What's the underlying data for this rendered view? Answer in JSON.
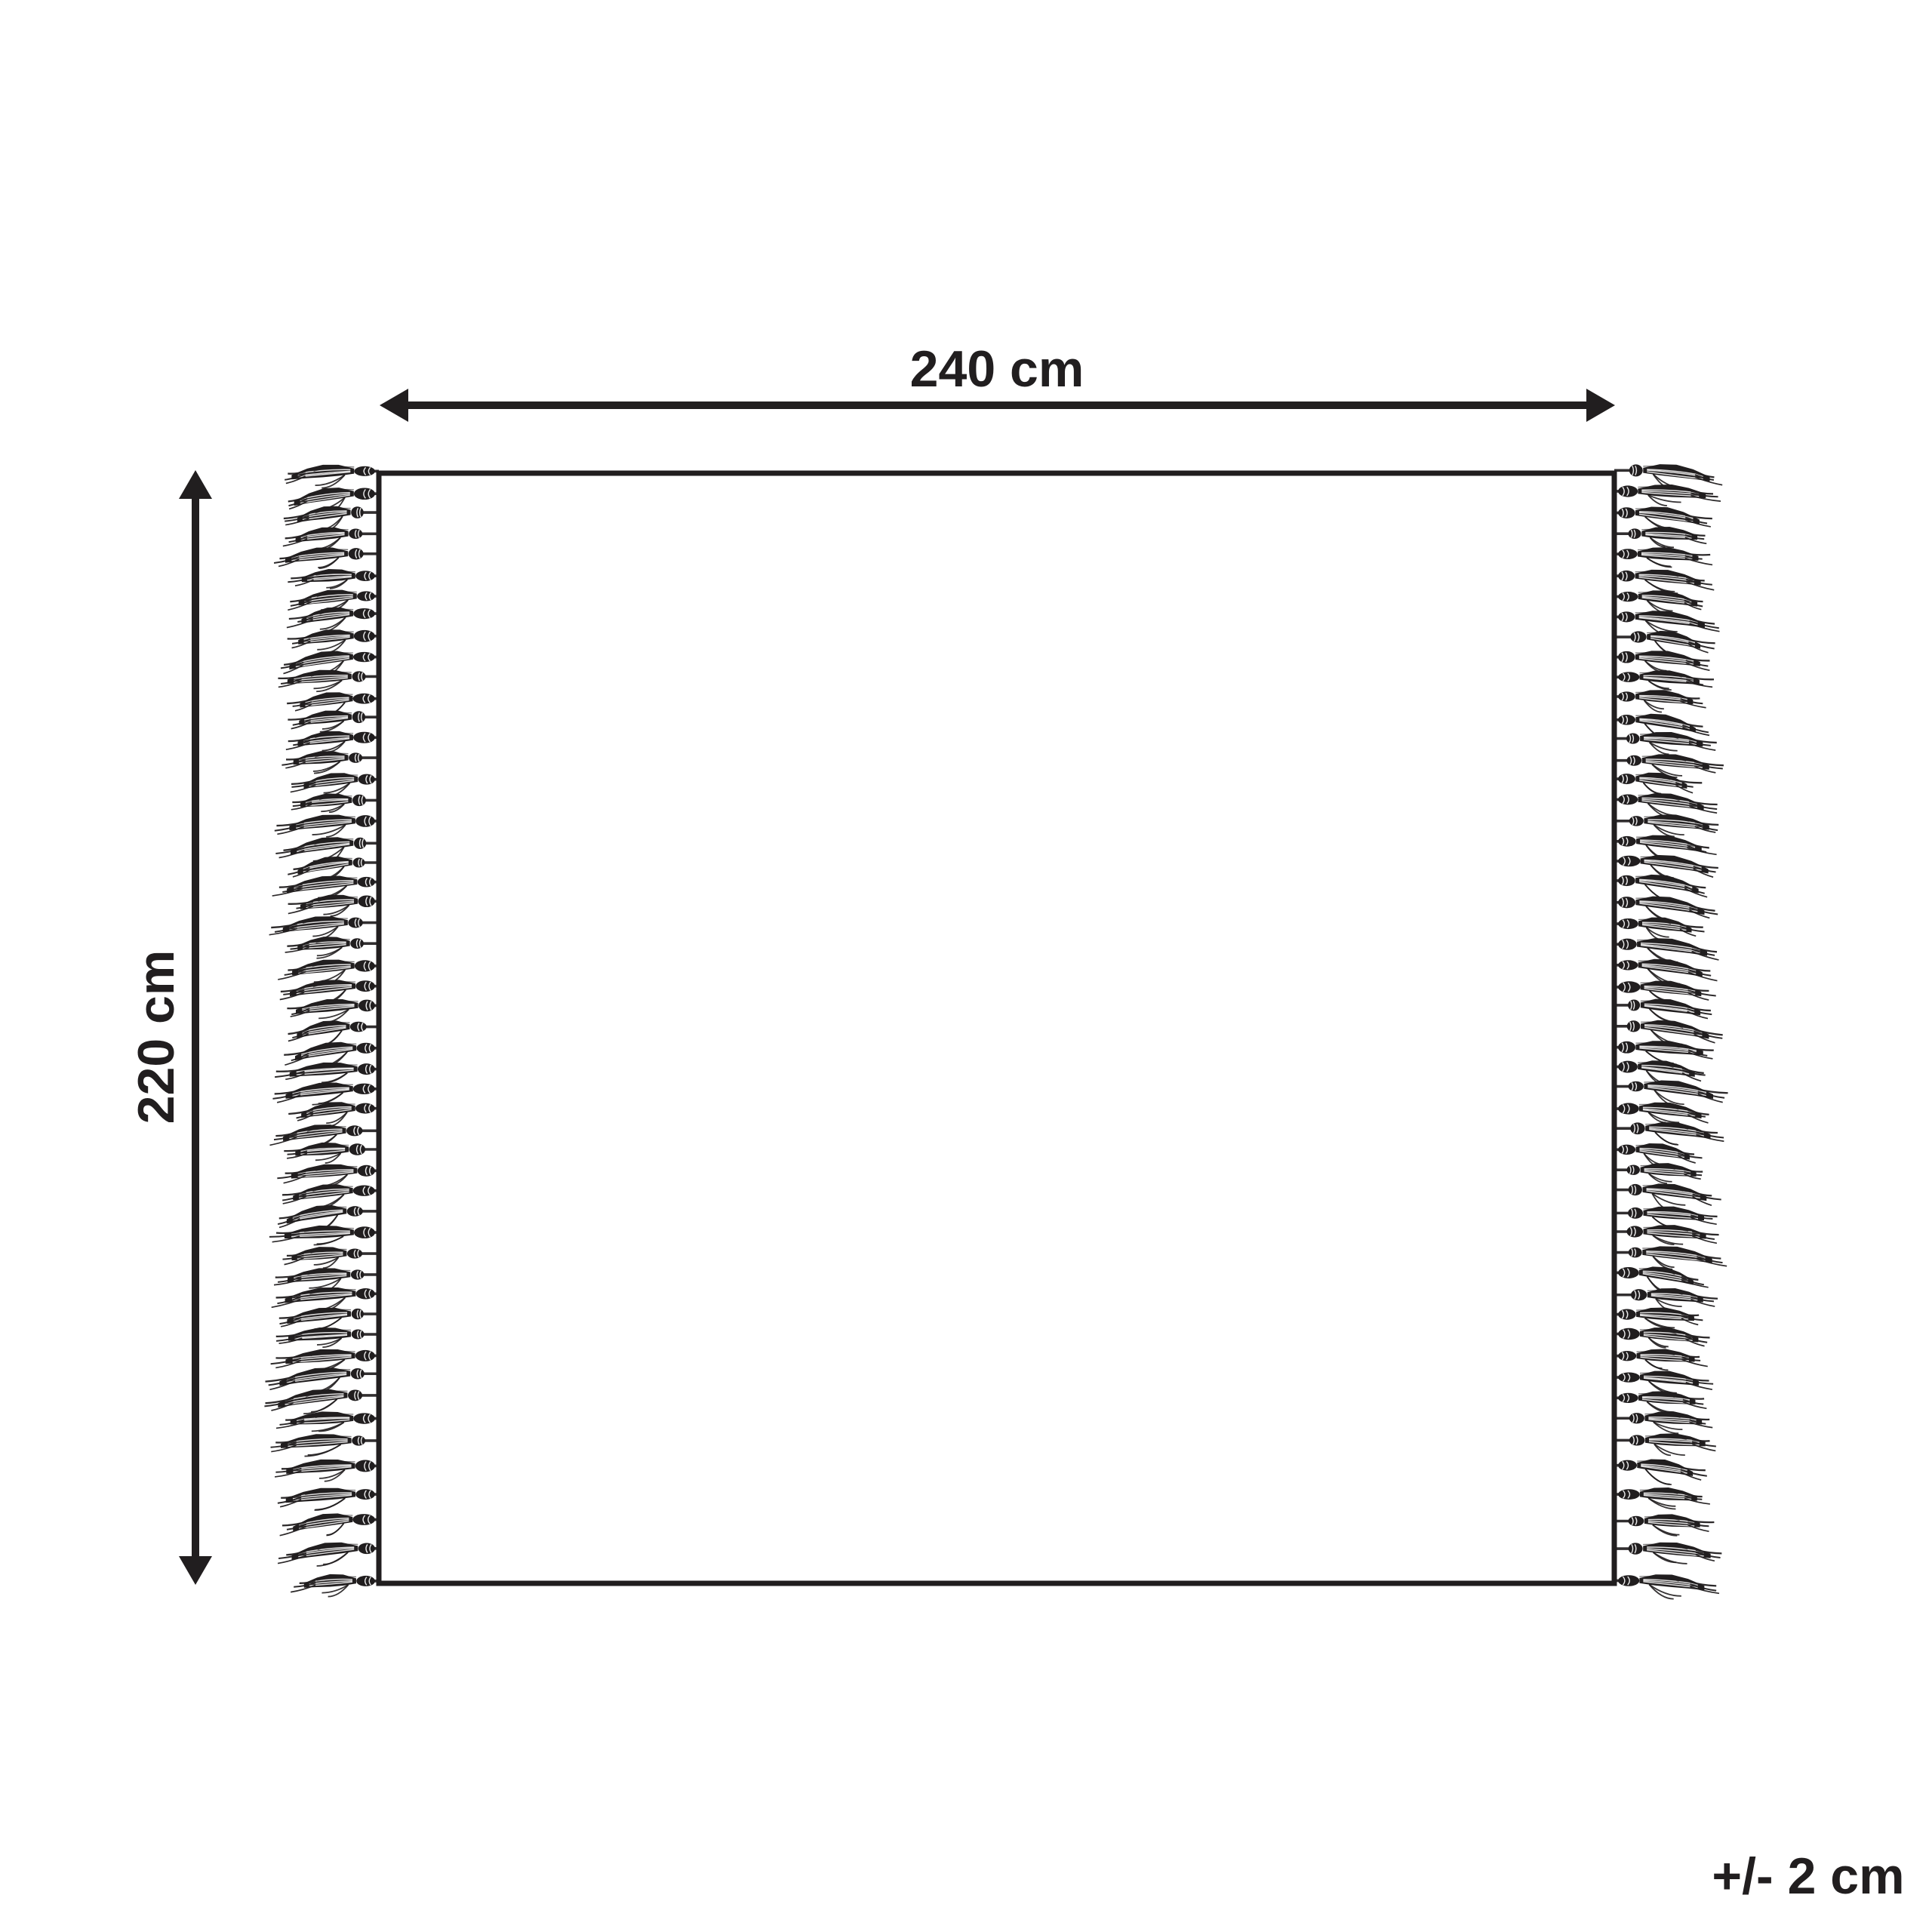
{
  "page": {
    "background_color": "#ffffff",
    "ink_color": "#211e1f"
  },
  "diagram": {
    "kind": "product dimension diagram",
    "subject": "blanket with tassel fringe on left and right edges",
    "width_label": "240 cm",
    "height_label": "220 cm",
    "tolerance_label": "+/- 2 cm",
    "icons": {
      "width_arrow": "double-headed-horizontal-arrow",
      "height_arrow": "double-headed-vertical-arrow"
    },
    "fringe": {
      "tassels_per_side": 53,
      "sides": [
        "left",
        "right"
      ]
    }
  }
}
